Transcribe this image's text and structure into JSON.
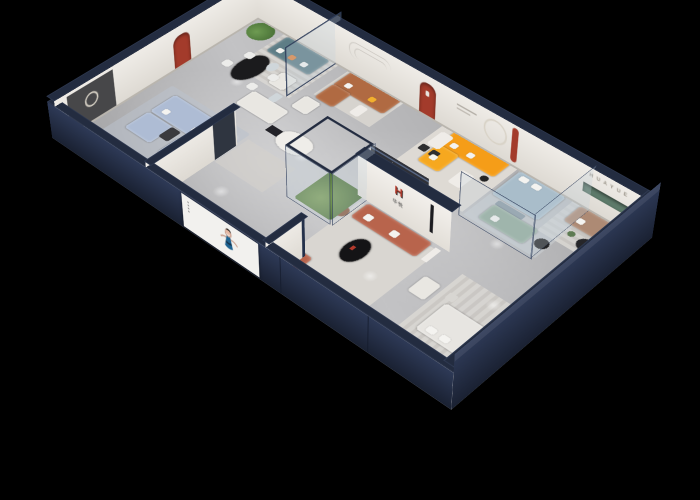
{
  "scene": {
    "title": "3D isometric cutaway render of a HUAYUE furniture showroom floor plan",
    "background": "#000000",
    "floor_color": "#b5b5b7",
    "wall_color": "#eae7e2",
    "exterior_wall_color": "#232c40"
  },
  "brand": {
    "wall_letters": "HUAYUE",
    "logo_mark": "H",
    "logo_characters": "华悦",
    "accent_red": "#b43a2c"
  },
  "front_poster": {
    "subject": "woman in blue dress presenting",
    "panel_color": "#f2f1ee",
    "dress_color": "#1f6391"
  },
  "rooms": [
    {
      "name": "living-room-light-blue",
      "furniture": [
        "light-blue sectional sofa",
        "dark media console",
        "coffee table",
        "red arch niche",
        "round wall mirror"
      ],
      "sofa_color": "#aebcd4"
    },
    {
      "name": "dining-area",
      "furniture": [
        "black oval marble table",
        "four white chairs"
      ],
      "table_color": "#1b1b1d"
    },
    {
      "name": "lounge-white",
      "furniture": [
        "white sofa",
        "white armchair",
        "dark console",
        "curved desk"
      ],
      "sofa_color": "#e9e7e2"
    },
    {
      "name": "vignette-teal",
      "furniture": [
        "teal sofa",
        "potted tree",
        "glass door",
        "striped rug"
      ],
      "sofa_color": "#5e7d86"
    },
    {
      "name": "vignette-caramel",
      "furniture": [
        "caramel leather corner sofa",
        "white coffee table"
      ],
      "sofa_color": "#b06a42"
    },
    {
      "name": "living-room-orange",
      "furniture": [
        "orange corner sofa",
        "white coffee table",
        "figure sculpture with light ring",
        "white dining table"
      ],
      "sofa_color": "#f59d18"
    },
    {
      "name": "bedroom-blue",
      "furniture": [
        "light blue bed",
        "sage green sofa",
        "glass partitions",
        "round side table"
      ],
      "bed_color": "#a9bdca",
      "sofa_color": "#92ab9a"
    },
    {
      "name": "lounge-huayue",
      "furniture": [
        "taupe sofa",
        "green wall niche",
        "brand letters",
        "round coffee table"
      ],
      "sofa_color": "#ad8a74"
    },
    {
      "name": "living-room-terracotta",
      "furniture": [
        "terracotta sofa",
        "black oval coffee table",
        "white ottoman",
        "teddy-bear sculpture",
        "brand logo wall"
      ],
      "sofa_color": "#b8644c"
    },
    {
      "name": "bedroom-white",
      "furniture": [
        "white bed",
        "striped rug"
      ],
      "bed_color": "#e7e5e1"
    },
    {
      "name": "entry-display",
      "furniture": [
        "glass terrarium case with plants",
        "poster screen",
        "blue-gray pouf"
      ]
    }
  ]
}
